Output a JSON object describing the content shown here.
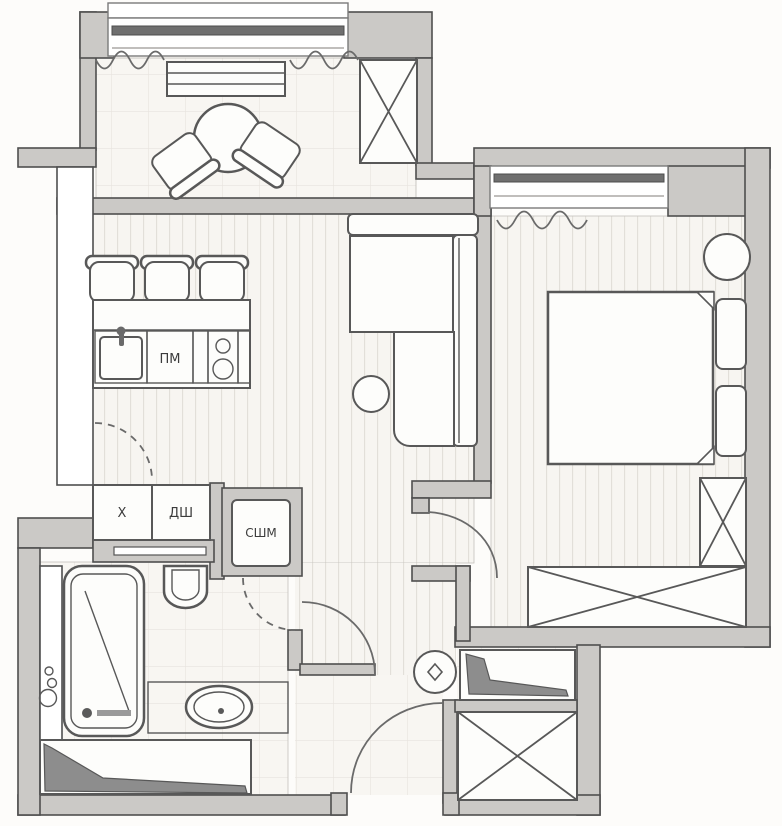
{
  "title": "apartment-floor-plan",
  "labels": {
    "dishwasher": "ПМ",
    "fridge": "Х",
    "cabinet": "ДШ",
    "washer_dryer": "СШМ"
  },
  "palette": {
    "paper": "#fdfcfa",
    "wall_fill": "#cbc9c6",
    "wall_stroke": "#4f4f4f",
    "line": "#585858",
    "furn_fill": "#fdfdfb",
    "glass": "#6f6f6f",
    "wedge": "#8d8d8d",
    "label_color": "#3c3c3c",
    "floor_light": "#f7f5f1",
    "stripe_line": "#e2dfd9",
    "tile_line": "#e7e4de"
  },
  "elements": [
    "balcony-dining-table",
    "balcony-chairs",
    "balcony-bench",
    "balcony-storage-box",
    "kitchen-bar-stools",
    "kitchen-counter",
    "kitchen-sink",
    "cooktop",
    "fridge-box",
    "cabinet-box",
    "washer-dryer-niche",
    "corner-sofa",
    "side-table",
    "curtains",
    "double-bed",
    "pillows",
    "bedside-chair",
    "wardrobe-tall",
    "wardrobe-long",
    "shower-cabin",
    "toilet",
    "washbasin",
    "plumbing-shaft",
    "entry-closet",
    "pouf",
    "shoe-wedge-shelves",
    "door-swings",
    "windows"
  ]
}
